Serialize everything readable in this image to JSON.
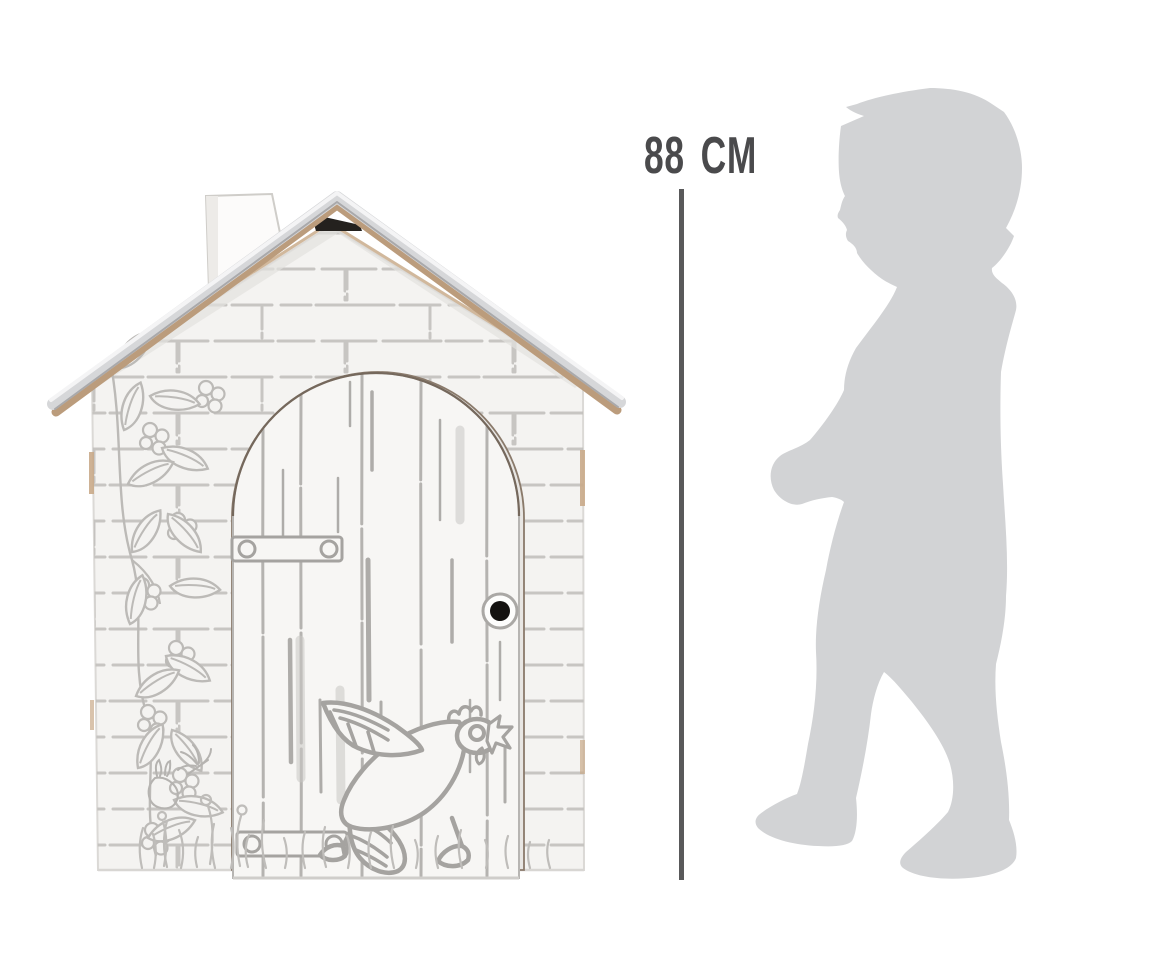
{
  "page": {
    "width": 1167,
    "height": 965,
    "background": "#ffffff"
  },
  "measurement": {
    "label": "88 cm",
    "text_color": "#4a4a4c",
    "line_color": "#59595a"
  },
  "playhouse": {
    "kind": "cardboard-playhouse-line-art",
    "paper_color": "#f4f3f1",
    "line_art_color": "#bcbab7",
    "roof_top_color": "#d6d7d9",
    "roof_edge_color": "#bb9c7c",
    "ridge_gap_color": "#24211e",
    "door_knob_color": "#141210",
    "motifs": [
      "brick-wall-print",
      "arched-plank-door",
      "hen-illustration",
      "climbing-vine",
      "grass-and-flowers",
      "rabbit-doodle",
      "dragonfly-doodle",
      "chimney"
    ]
  },
  "silhouette": {
    "kind": "toddler-child-profile",
    "fill_color": "#d2d3d5"
  }
}
